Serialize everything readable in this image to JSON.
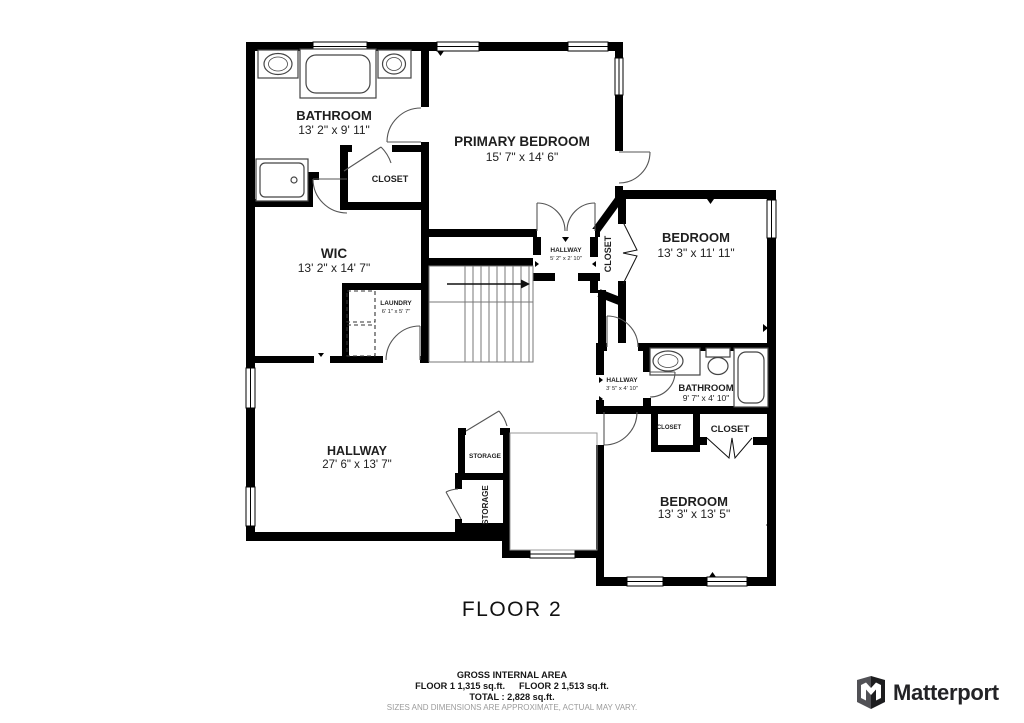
{
  "title": "FLOOR 2",
  "rooms": {
    "bathroom1": {
      "label": "BATHROOM",
      "dims": "13' 2\" x 9' 11\""
    },
    "closet_primary": {
      "label": "CLOSET"
    },
    "primary_bedroom": {
      "label": "PRIMARY BEDROOM",
      "dims": "15' 7\" x 14' 6\""
    },
    "wic": {
      "label": "WIC",
      "dims": "13' 2\" x 14' 7\""
    },
    "laundry": {
      "label": "LAUNDRY",
      "dims": "6' 1\" x 5' 7\""
    },
    "hallway_upper": {
      "label": "HALLWAY",
      "dims": "5' 2\" x 2' 10\""
    },
    "closet_hall": {
      "label": "CLOSET"
    },
    "bedroom_right": {
      "label": "BEDROOM",
      "dims": "13' 3\" x 11' 11\""
    },
    "hallway_small": {
      "label": "HALLWAY",
      "dims": "3' 5\" x 4' 10\""
    },
    "bathroom2": {
      "label": "BATHROOM",
      "dims": "9' 7\" x 4' 10\""
    },
    "closet_small": {
      "label": "CLOSET"
    },
    "closet_large": {
      "label": "CLOSET"
    },
    "bedroom_bottom": {
      "label": "BEDROOM",
      "dims": "13' 3\" x 13' 5\""
    },
    "hallway_main": {
      "label": "HALLWAY",
      "dims": "27' 6\" x 13' 7\""
    },
    "storage_top": {
      "label": "STORAGE"
    },
    "storage_bottom": {
      "label": "STORAGE"
    }
  },
  "footer": {
    "area_title": "GROSS INTERNAL AREA",
    "area_floor1": "FLOOR 1 1,315 sq.ft.",
    "area_floor2": "FLOOR 2 1,513 sq.ft.",
    "area_total": "TOTAL :  2,828 sq.ft.",
    "disclaimer": "SIZES AND DIMENSIONS ARE APPROXIMATE, ACTUAL MAY VARY."
  },
  "branding": {
    "wordmark": "Matterport"
  },
  "colors": {
    "wall": "#000000",
    "text": "#1f1f1f",
    "muted": "#9b9b9b",
    "brand": "#1d1d1f"
  }
}
